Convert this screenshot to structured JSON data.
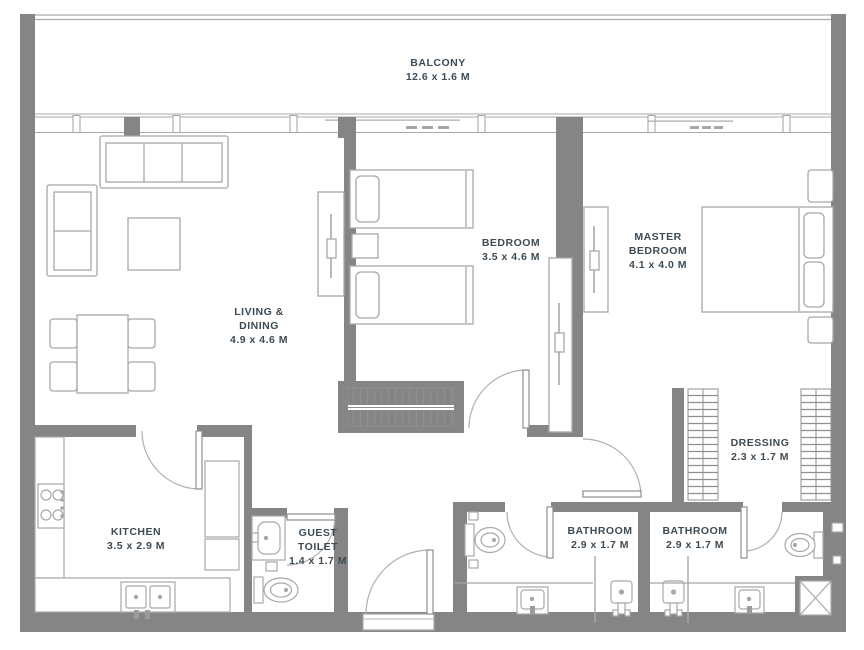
{
  "app": {
    "type": "residential-apartment-floor-plan"
  },
  "colors": {
    "wall": "#858585",
    "furniture_line": "#a8a8a8",
    "text": "#3d4b55",
    "background": "#ffffff"
  },
  "rooms": [
    {
      "id": "balcony",
      "name": "BALCONY",
      "dimensions": "12.6 x 1.6 M"
    },
    {
      "id": "living-dining",
      "name": "LIVING & DINING",
      "dimensions": "4.9 x 4.6 M"
    },
    {
      "id": "bedroom",
      "name": "BEDROOM",
      "dimensions": "3.5 x 4.6 M"
    },
    {
      "id": "master-bedroom",
      "name": "MASTER BEDROOM",
      "dimensions": "4.1 x 4.0 M"
    },
    {
      "id": "dressing",
      "name": "DRESSING",
      "dimensions": "2.3 x 1.7 M"
    },
    {
      "id": "kitchen",
      "name": "KITCHEN",
      "dimensions": "3.5 x 2.9 M"
    },
    {
      "id": "guest-toilet",
      "name": "GUEST TOILET",
      "dimensions": "1.4 x 1.7 M"
    },
    {
      "id": "bathroom-1",
      "name": "BATHROOM",
      "dimensions": "2.9 x 1.7 M"
    },
    {
      "id": "bathroom-2",
      "name": "BATHROOM",
      "dimensions": "2.9 x 1.7 M"
    }
  ],
  "fixtures": {
    "living-dining": [
      "three-seat-sofa",
      "two-seat-sofa",
      "coffee-table",
      "dining-table",
      "dining-chairs-x4",
      "tv-console"
    ],
    "bedroom": [
      "twin-bed-x2",
      "nightstand",
      "wardrobe",
      "tv-console"
    ],
    "master-bedroom": [
      "double-bed",
      "nightstand-x2",
      "tv-console"
    ],
    "dressing": [
      "wardrobe-x2"
    ],
    "kitchen": [
      "stove-4-burner",
      "double-sink",
      "counter-l-shape",
      "tall-units"
    ],
    "guest-toilet": [
      "washbasin",
      "toilet"
    ],
    "bathroom-1": [
      "toilet",
      "washbasin",
      "shower"
    ],
    "bathroom-2": [
      "toilet",
      "washbasin",
      "shower",
      "service-shaft"
    ],
    "openings": [
      "balcony-sliding-doors",
      "entrance-door",
      "interior-doors-x6",
      "window-band"
    ]
  }
}
